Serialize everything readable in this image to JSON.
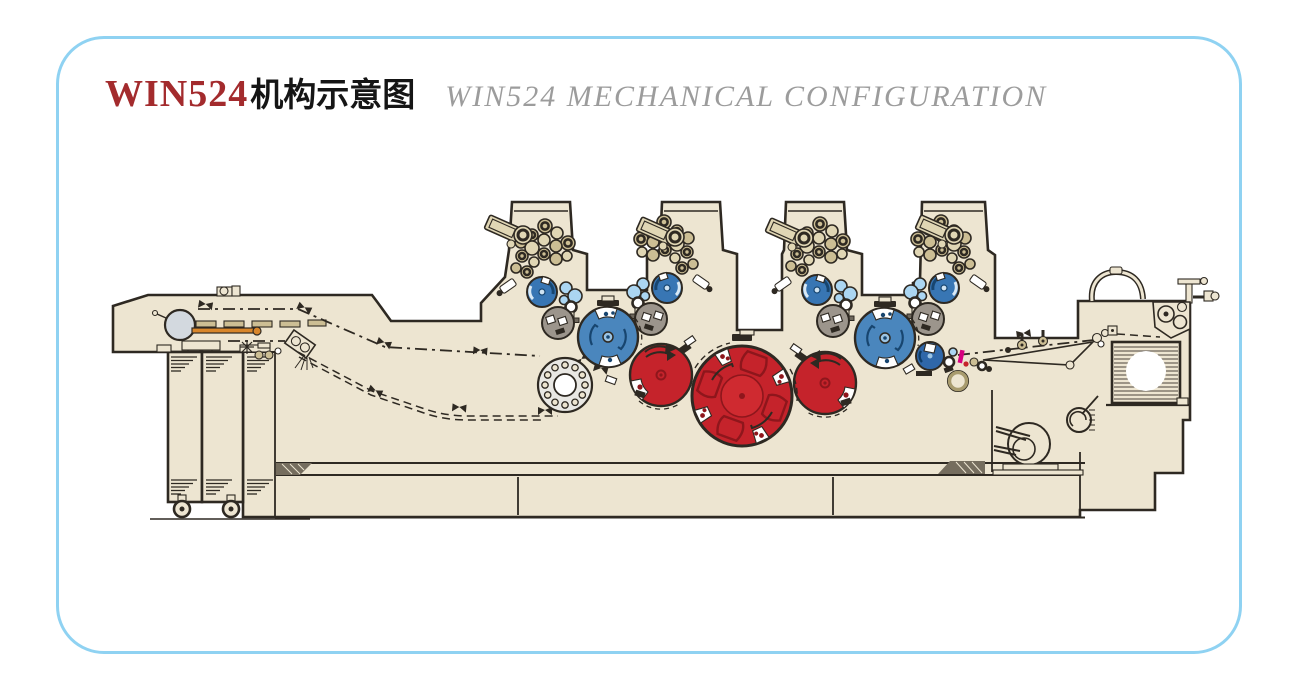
{
  "title": {
    "brand": "WIN524",
    "cn_suffix": "机构示意图",
    "en": "WIN524 MECHANICAL CONFIGURATION"
  },
  "colors": {
    "frame": "#8FD2F2",
    "title_red": "#A32B2D",
    "title_gray": "#9C9C9C",
    "body": "#EDE5D1",
    "outline": "#2E2922",
    "blue": "#4A86BD",
    "blue_plate": "#3876B4",
    "blue_dark": "#17456F",
    "light_blue": "#ABD6F2",
    "red": "#C5232B",
    "red_light": "#CF2A30",
    "red_dark": "#8E161C",
    "gray_cyl": "#9C958C",
    "tan": "#CCBE94",
    "tan_light": "#E0D6B4",
    "drum": "#E9E8E4",
    "orange": "#D8862B",
    "magenta": "#D6017F",
    "olive": "#A89B6E"
  },
  "diagram": {
    "printing_towers": 4,
    "parts": [
      "paper-roll",
      "infeed-cabinet",
      "web-path",
      "ink-fountain",
      "inking-rollers",
      "plate-cylinder",
      "dampening-rollers",
      "gray-transfer-cylinder",
      "blanket-cylinder",
      "impression-cylinder",
      "central-impression-cylinder",
      "transfer-drum",
      "delivery-arm",
      "delivery-stack",
      "air-hose",
      "motor",
      "fan"
    ]
  }
}
